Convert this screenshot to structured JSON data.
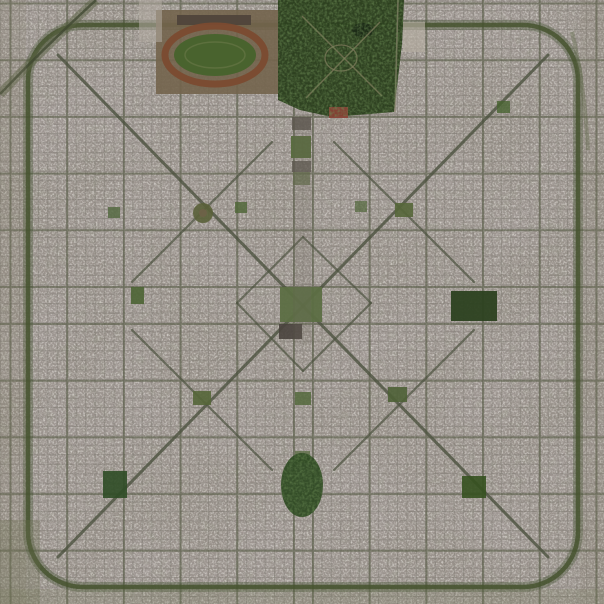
{
  "scene": {
    "title": "aerial-satellite-photo",
    "description": "Overhead satellite photograph of the planned grid city of La Plata, Argentina: square street grid with diagonal avenues, central plaza and cathedral, racecourse and forest park at the top, ring road with rounded corners, scattered green plazas",
    "width": 604,
    "height": 604
  },
  "palette": {
    "base": "#98918a",
    "speckle_light": "#dcd8d0",
    "speckle_dark": "#4e4a43",
    "mottle_warm": "#95807d",
    "street": "#6e6b60",
    "avenue": "#555a43",
    "ring": "#47532f",
    "diagonal": "#4d5340",
    "park_green": "#2b3f1e",
    "plaza_green": "#55693b",
    "track_brown": "#7b4b30"
  },
  "grid": {
    "pitch": 9.45,
    "minor_offset_x": 0.6,
    "minor_offset_y": 1.2,
    "minor_color": "#6e6b60",
    "minor_width": 1,
    "minor_opacity": 0.33,
    "avenue_color": "#555a43",
    "avenue_width": 2,
    "avenue_opacity": 0.58,
    "avenue_x": [
      10.5,
      67.2,
      123.9,
      180.6,
      237.3,
      294,
      313,
      369.7,
      426.4,
      483.1,
      539.8,
      596.5
    ],
    "avenue_y": [
      3.5,
      60.2,
      116.9,
      173.6,
      230.3,
      287,
      324,
      380.7,
      437.4,
      494.1,
      550.8
    ]
  },
  "ring_road": {
    "x": 28,
    "y": 25,
    "w": 550,
    "h": 562,
    "r": 55,
    "color": "#47532f",
    "width": 4.5,
    "halo_color": "#3d4c2c",
    "halo_width": 10,
    "halo_opacity": 0.35
  },
  "diagonals": [
    {
      "name": "diagonal-73",
      "x1": 58,
      "y1": 55,
      "x2": 548,
      "y2": 557,
      "w": 3,
      "o": 0.8
    },
    {
      "name": "diagonal-74",
      "x1": 548,
      "y1": 55,
      "x2": 58,
      "y2": 557,
      "w": 3,
      "o": 0.8
    },
    {
      "name": "cross-diagonal-nw",
      "x1": 132,
      "y1": 282,
      "x2": 272,
      "y2": 142,
      "w": 2.2,
      "o": 0.7
    },
    {
      "name": "cross-diagonal-ne",
      "x1": 334,
      "y1": 142,
      "x2": 474,
      "y2": 282,
      "w": 2.2,
      "o": 0.7
    },
    {
      "name": "cross-diagonal-sw",
      "x1": 132,
      "y1": 330,
      "x2": 272,
      "y2": 470,
      "w": 2.2,
      "o": 0.7
    },
    {
      "name": "cross-diagonal-se",
      "x1": 334,
      "y1": 470,
      "x2": 474,
      "y2": 330,
      "w": 2.2,
      "o": 0.7
    },
    {
      "name": "inner-diamond-nw",
      "x1": 303,
      "y1": 237,
      "x2": 237,
      "y2": 303,
      "w": 2,
      "o": 0.7
    },
    {
      "name": "inner-diamond-sw",
      "x1": 237,
      "y1": 303,
      "x2": 303,
      "y2": 371,
      "w": 2,
      "o": 0.7
    },
    {
      "name": "inner-diamond-se",
      "x1": 303,
      "y1": 371,
      "x2": 371,
      "y2": 303,
      "w": 2,
      "o": 0.7
    },
    {
      "name": "inner-diamond-ne",
      "x1": 371,
      "y1": 303,
      "x2": 303,
      "y2": 237,
      "w": 2,
      "o": 0.7
    }
  ],
  "plazas": [
    {
      "name": "plaza-san-martin",
      "shape": "rect",
      "x": 291,
      "y": 136,
      "w": 20,
      "h": 22,
      "fill": "#55693b",
      "o": 0.95
    },
    {
      "name": "plaza-rivadavia",
      "shape": "rect",
      "x": 293,
      "y": 172,
      "w": 17,
      "h": 13,
      "fill": "#5f6b47",
      "o": 0.7
    },
    {
      "name": "government-house-block",
      "shape": "rect",
      "x": 292,
      "y": 117,
      "w": 19,
      "h": 13,
      "fill": "#57514a",
      "o": 0.8
    },
    {
      "name": "legislature-block",
      "shape": "rect",
      "x": 292,
      "y": 161,
      "w": 19,
      "h": 11,
      "fill": "#5a544c",
      "o": 0.75
    },
    {
      "name": "plaza-moreno",
      "shape": "rect",
      "x": 280,
      "y": 287,
      "w": 42,
      "h": 35,
      "fill": "#5c6e43",
      "o": 0.95
    },
    {
      "name": "cathedral-block",
      "shape": "rect",
      "x": 279,
      "y": 324,
      "w": 23,
      "h": 15,
      "fill": "#49433d",
      "o": 0.9
    },
    {
      "name": "plaza-nw-circular",
      "shape": "circle",
      "cx": 203,
      "cy": 213,
      "r": 10,
      "fill": "#5a6139",
      "o": 0.9
    },
    {
      "name": "plaza-nw-circular-center",
      "shape": "circle",
      "cx": 203,
      "cy": 213,
      "r": 4,
      "fill": "#6e6248",
      "o": 0.9
    },
    {
      "name": "plaza-ne",
      "shape": "rect",
      "x": 395,
      "y": 203,
      "w": 18,
      "h": 14,
      "fill": "#556639",
      "o": 0.9
    },
    {
      "name": "plaza-sw",
      "shape": "rect",
      "x": 193,
      "y": 391,
      "w": 18,
      "h": 14,
      "fill": "#556639",
      "o": 0.9
    },
    {
      "name": "plaza-se",
      "shape": "rect",
      "x": 388,
      "y": 387,
      "w": 19,
      "h": 15,
      "fill": "#4e6136",
      "o": 0.9
    },
    {
      "name": "plaza-small-nw",
      "shape": "rect",
      "x": 235,
      "y": 202,
      "w": 12,
      "h": 11,
      "fill": "#51673a",
      "o": 0.85
    },
    {
      "name": "plaza-small-ne",
      "shape": "rect",
      "x": 355,
      "y": 201,
      "w": 12,
      "h": 11,
      "fill": "#51673a",
      "o": 0.7
    },
    {
      "name": "plaza-mid-left",
      "shape": "rect",
      "x": 131,
      "y": 287,
      "w": 13,
      "h": 17,
      "fill": "#4c6434",
      "o": 0.9
    },
    {
      "name": "park-right-dark",
      "shape": "rect",
      "x": 451,
      "y": 291,
      "w": 46,
      "h": 30,
      "fill": "#2c4120",
      "o": 0.95
    },
    {
      "name": "plaza-axis-south",
      "shape": "rect",
      "x": 295,
      "y": 392,
      "w": 16,
      "h": 13,
      "fill": "#54683c",
      "o": 0.85
    },
    {
      "name": "plaza-axis-south-2",
      "shape": "rect",
      "x": 295,
      "y": 451,
      "w": 15,
      "h": 12,
      "fill": "#54683c",
      "o": 0.7
    },
    {
      "name": "parque-saavedra",
      "shape": "ellipse",
      "cx": 302,
      "cy": 485,
      "rx": 21,
      "ry": 32,
      "fill": "#2f4a24",
      "o": 0.95
    },
    {
      "name": "plaza-bottom-left",
      "shape": "rect",
      "x": 103,
      "y": 471,
      "w": 24,
      "h": 27,
      "fill": "#2f4c26",
      "o": 0.9
    },
    {
      "name": "plaza-bottom-right",
      "shape": "rect",
      "x": 462,
      "y": 476,
      "w": 24,
      "h": 22,
      "fill": "#35511f",
      "o": 0.9
    },
    {
      "name": "plaza-right-small",
      "shape": "rect",
      "x": 497,
      "y": 101,
      "w": 13,
      "h": 12,
      "fill": "#47632f",
      "o": 0.8
    },
    {
      "name": "plaza-left-small",
      "shape": "rect",
      "x": 108,
      "y": 207,
      "w": 12,
      "h": 11,
      "fill": "#50663c",
      "o": 0.8
    }
  ],
  "landmarks": [
    {
      "name": "racecourse-grounds",
      "shape": "rect",
      "x": 156,
      "y": 10,
      "w": 124,
      "h": 84,
      "fill": "#73644d",
      "o": 0.9
    },
    {
      "name": "racecourse-stands",
      "shape": "rect",
      "x": 177,
      "y": 15,
      "w": 74,
      "h": 10,
      "fill": "#4e423a",
      "o": 0.9
    },
    {
      "name": "racecourse-track",
      "shape": "ellipse",
      "cx": 215,
      "cy": 55,
      "rx": 50,
      "ry": 29,
      "fill": "none",
      "stroke": "#7b4b30",
      "sw": 7,
      "o": 0.95
    },
    {
      "name": "racecourse-infield",
      "shape": "ellipse",
      "cx": 215,
      "cy": 55,
      "rx": 41,
      "ry": 21,
      "fill": "#47632c",
      "o": 0.95
    },
    {
      "name": "racecourse-infield-path",
      "shape": "ellipse",
      "cx": 215,
      "cy": 55,
      "rx": 30,
      "ry": 13,
      "fill": "none",
      "stroke": "#6b7a4a",
      "sw": 1.5,
      "o": 0.6
    },
    {
      "name": "forest-park",
      "shape": "polygon",
      "points": "278,0 404,0 402,44 394,112 332,117 300,110 278,100",
      "fill": "#2b3f1e",
      "o": 0.97
    },
    {
      "name": "forest-lake",
      "shape": "ellipse",
      "cx": 363,
      "cy": 30,
      "rx": 11,
      "ry": 7,
      "fill": "#1c2a16",
      "o": 0.9
    },
    {
      "name": "forest-path-1",
      "shape": "path",
      "d": "M302,16 L382,96",
      "stroke": "#877f63",
      "sw": 1.5,
      "fill": "none",
      "o": 0.7
    },
    {
      "name": "forest-path-2",
      "shape": "path",
      "d": "M380,22 L306,98",
      "stroke": "#877f63",
      "sw": 1.5,
      "fill": "none",
      "o": 0.7
    },
    {
      "name": "forest-ring-path",
      "shape": "ellipse",
      "cx": 341,
      "cy": 58,
      "rx": 16,
      "ry": 13,
      "fill": "none",
      "stroke": "#877f63",
      "sw": 1.3,
      "o": 0.7
    },
    {
      "name": "forest-edge-road",
      "shape": "path",
      "d": "M398,0 L395,112",
      "stroke": "#8d8670",
      "sw": 1.6,
      "fill": "none",
      "o": 0.7
    },
    {
      "name": "stadium-red-roof",
      "shape": "rect",
      "x": 329,
      "y": 107,
      "w": 19,
      "h": 11,
      "fill": "#8c4136",
      "o": 0.9
    },
    {
      "name": "white-building-cluster",
      "shape": "rect",
      "x": 403,
      "y": 22,
      "w": 22,
      "h": 30,
      "fill": "#b5ada1",
      "o": 0.65
    },
    {
      "name": "industrial-white-left",
      "shape": "rect",
      "x": 139,
      "y": 0,
      "w": 23,
      "h": 42,
      "fill": "#b3aca2",
      "o": 0.55
    },
    {
      "name": "railway-curve",
      "shape": "path",
      "d": "M96,0 Q46,46 0,94",
      "stroke": "#5a6143",
      "sw": 9,
      "fill": "none",
      "o": 0.5
    },
    {
      "name": "railway-track",
      "shape": "path",
      "d": "M96,0 Q46,46 0,94",
      "stroke": "#3f4730",
      "sw": 2.5,
      "fill": "none",
      "o": 0.75
    },
    {
      "name": "outer-road-right",
      "shape": "path",
      "d": "M572,32 Q584,80 588,150",
      "stroke": "#5f6a48",
      "sw": 4,
      "fill": "none",
      "o": 0.4
    }
  ],
  "tints": [
    {
      "name": "outside-ring-left",
      "shape": "rect",
      "x": 0,
      "y": 0,
      "w": 26,
      "h": 604,
      "fill": "#7e7a64",
      "o": 0.18
    },
    {
      "name": "outside-ring-right",
      "shape": "rect",
      "x": 580,
      "y": 0,
      "w": 24,
      "h": 604,
      "fill": "#7e7a64",
      "o": 0.15
    },
    {
      "name": "outside-ring-bottom",
      "shape": "rect",
      "x": 0,
      "y": 589,
      "w": 604,
      "h": 15,
      "fill": "#767a5c",
      "o": 0.22
    },
    {
      "name": "rural-corner-sw",
      "shape": "rect",
      "x": 0,
      "y": 520,
      "w": 40,
      "h": 84,
      "fill": "#6d7050",
      "o": 0.28
    },
    {
      "name": "civic-axis-shade",
      "shape": "rect",
      "x": 293,
      "y": 115,
      "w": 18,
      "h": 230,
      "fill": "#6f6a5e",
      "o": 0.18
    }
  ]
}
